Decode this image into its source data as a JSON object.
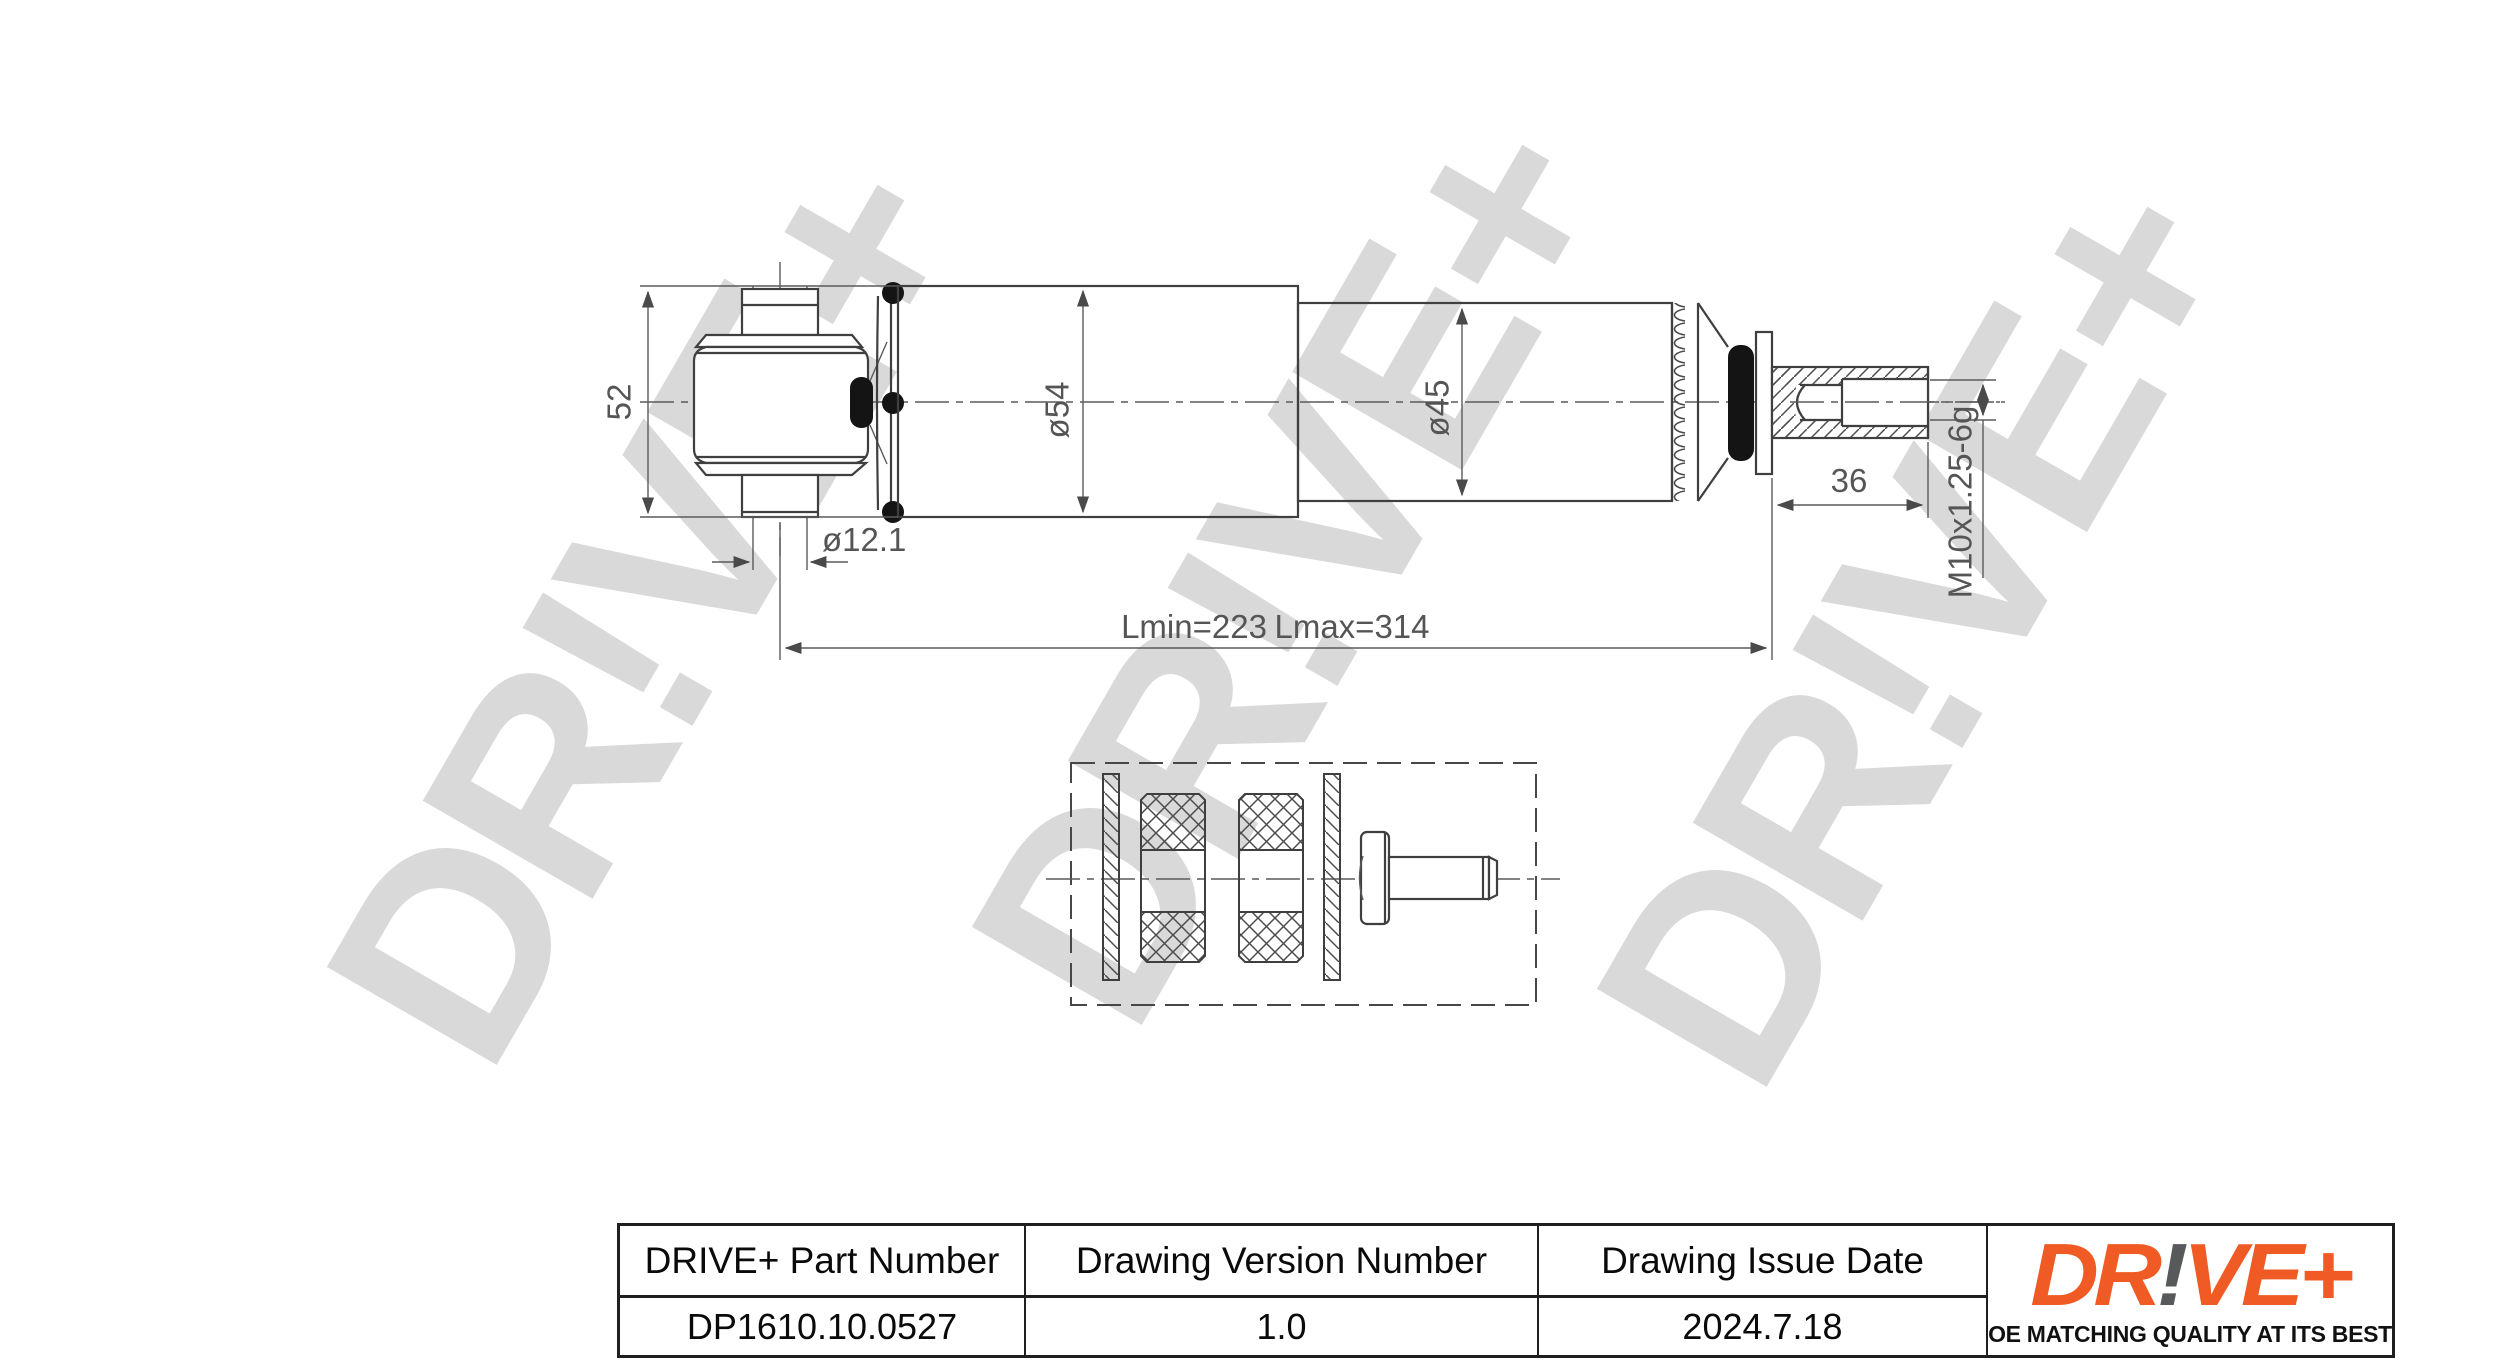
{
  "watermark": {
    "text": "DR!VE+"
  },
  "drawing": {
    "dimensions": {
      "eye_height": "52",
      "eye_pin_bore": "ø12.1",
      "body_diameter": "ø54",
      "tube_diameter": "ø45",
      "stud_length": "36",
      "thread_spec": "M10x1.25-6g",
      "length_min": "Lmin=223",
      "length_max": "Lmax=314"
    }
  },
  "title_block": {
    "columns": [
      {
        "header": "DRIVE+ Part Number",
        "value": "DP1610.10.0527"
      },
      {
        "header": "Drawing Version Number",
        "value": "1.0"
      },
      {
        "header": "Drawing Issue Date",
        "value": "2024.7.18"
      }
    ]
  },
  "logo": {
    "part1": "DR",
    "excl": "!",
    "part2": "VE+",
    "tagline": "OE MATCHING QUALITY AT ITS BEST",
    "orange_color": "#f05a24",
    "gray_color": "#58595b"
  }
}
